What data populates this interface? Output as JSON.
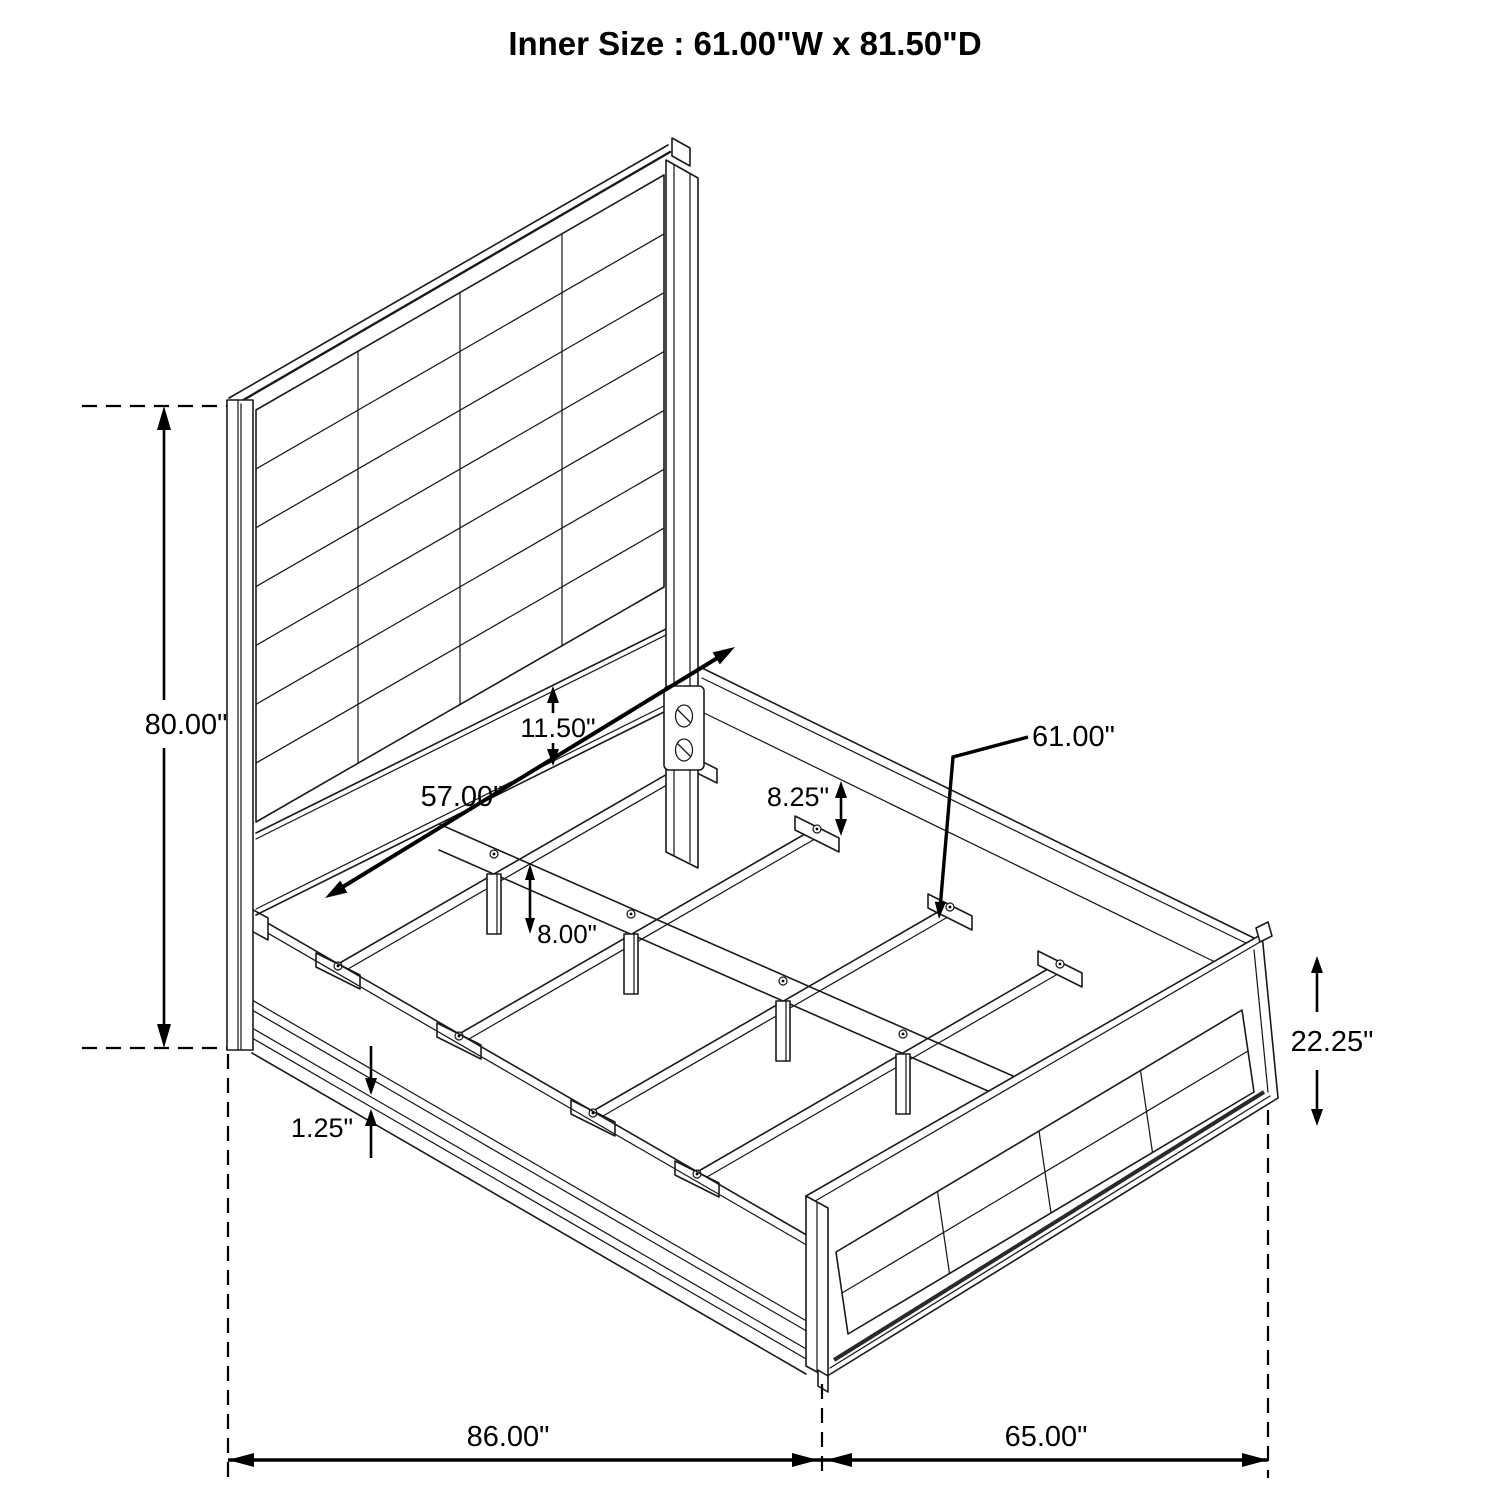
{
  "title": "Inner Size : 61.00\"W x 81.50\"D",
  "colors": {
    "line": "#000000",
    "background": "#ffffff"
  },
  "diagram_type": "bed-frame-dimension-drawing",
  "dims": {
    "headboard_height": "80.00\"",
    "headboard_rail_height": "11.50\"",
    "headboard_rail_length": "57.00\"",
    "rail_to_slat_drop": "8.25\"",
    "slat_length": "61.00\"",
    "support_leg_height": "8.00\"",
    "base_trim": "1.25\"",
    "footboard_height": "22.25\"",
    "overall_depth": "86.00\"",
    "overall_width": "65.00\""
  }
}
